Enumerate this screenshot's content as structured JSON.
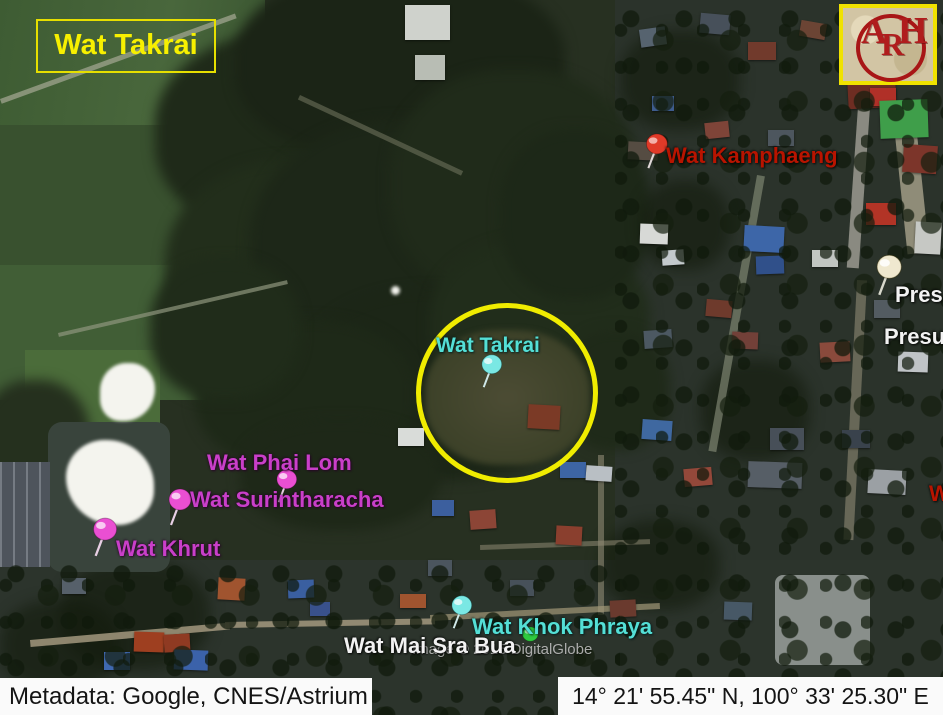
{
  "title_box": {
    "text": "Wat Takrai"
  },
  "logo": {
    "a": "A",
    "r": "R",
    "h": "H"
  },
  "markers": {
    "wat_kamphaeng": {
      "label": "Wat Kamphaeng"
    },
    "pres": {
      "label": "Pres"
    },
    "presu": {
      "label": "Presu"
    },
    "wat_takrai": {
      "label": "Wat Takrai"
    },
    "wat_phai_lom": {
      "label": "Wat Phai Lom"
    },
    "wat_surintharacha": {
      "label": "Wat Surintharacha"
    },
    "wat_khrut": {
      "label": "Wat Khrut"
    },
    "wat_khok_phraya": {
      "label": "Wat Khok Phraya"
    },
    "wat_mai_sra_bua": {
      "label": "Wat Mai Sra Bua"
    },
    "w_partial": {
      "label": "W"
    }
  },
  "watermark": "Image © 2015 DigitalGlobe",
  "footer": {
    "metadata": "Metadata: Google, CNES/Astrium",
    "coordinates": "14° 21' 55.45\" N, 100° 33' 25.30\" E"
  },
  "colors": {
    "title_yellow": "#f7f000",
    "circle_yellow": "#f0ec00",
    "label_red": "#b81400",
    "label_magenta": "#c93fc9",
    "label_cyan": "#54dfd6",
    "label_white": "#f2f2f2",
    "pin_red": "#e03a28",
    "pin_pink": "#ea4fd2",
    "pin_cyan": "#7ae8e4",
    "pin_white": "#efe8cf",
    "pin_green": "#2fcb3f"
  }
}
